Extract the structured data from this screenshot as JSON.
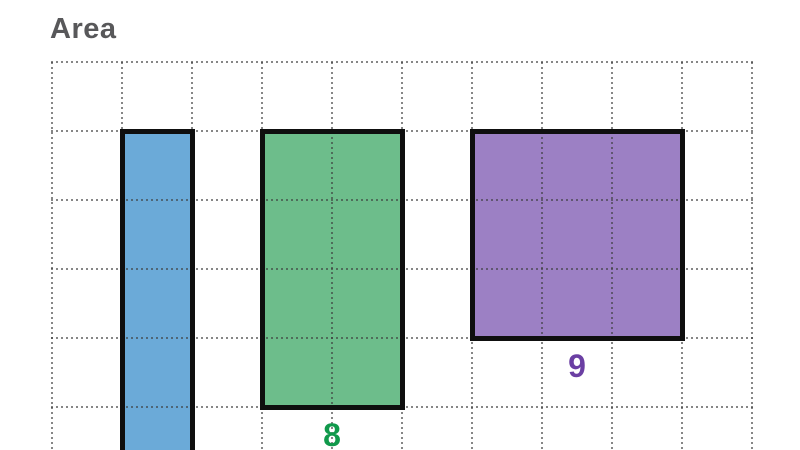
{
  "title": "Area",
  "title_color": "#58585A",
  "grid": {
    "columns": 10,
    "visible_rows": 6,
    "line_style": "dotted",
    "line_color": "#8E8E8E"
  },
  "outline_color": "#0F0F0F",
  "shapes": [
    {
      "id": "blue-rectangle",
      "fill": "#6BAAD8",
      "grid_x": 1,
      "grid_y": 1,
      "width_units": 1,
      "height_units": null,
      "cut_off_bottom": true,
      "label": "",
      "label_color": ""
    },
    {
      "id": "green-rectangle",
      "fill": "#6DBD8B",
      "grid_x": 3,
      "grid_y": 1,
      "width_units": 2,
      "height_units": 4,
      "area": 8,
      "cut_off_bottom": false,
      "label": "8",
      "label_color": "#10994B"
    },
    {
      "id": "purple-rectangle",
      "fill": "#9C80C4",
      "grid_x": 6,
      "grid_y": 1,
      "width_units": 3,
      "height_units": 3,
      "area": 9,
      "cut_off_bottom": false,
      "label": "9",
      "label_color": "#6B3FA3"
    }
  ]
}
